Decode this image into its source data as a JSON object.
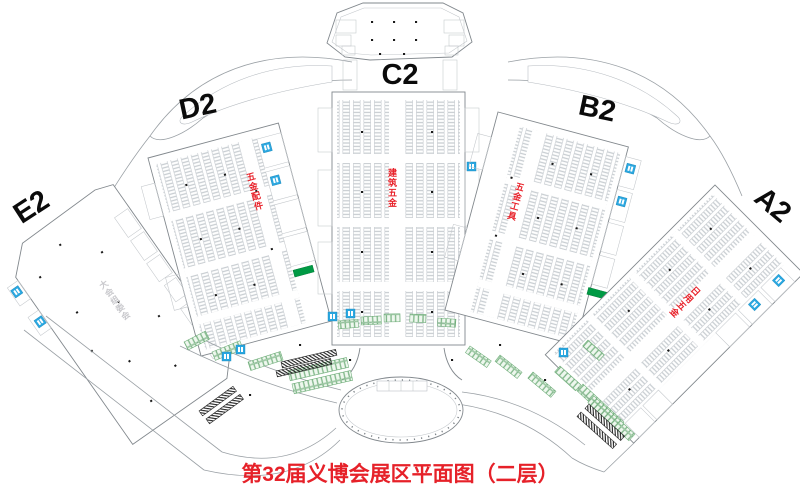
{
  "caption": {
    "text": "第32届义博会展区平面图（二层）",
    "color": "#e62129"
  },
  "halls": [
    {
      "id": "E2",
      "label": "E2",
      "category": "大会组委会",
      "category_color": "#c9c9cd"
    },
    {
      "id": "D2",
      "label": "D2",
      "category": "五金配件",
      "category_color": "#e8232b"
    },
    {
      "id": "C2",
      "label": "C2",
      "category": "建筑五金",
      "category_color": "#e8232b"
    },
    {
      "id": "B2",
      "label": "B2",
      "category": "五金工具",
      "category_color": "#e8232b"
    },
    {
      "id": "A2",
      "label": "A2",
      "category": "日用五金",
      "category_color": "#e8232b"
    }
  ],
  "icons": {
    "toilet": "restroom-square",
    "escalator": "green-escalator-block",
    "stairs": "hatched-stair-strip",
    "booths": "booth-grid-cells"
  },
  "colors": {
    "wall": "#82888d",
    "light_line": "#c3c7cb",
    "booth_line": "#b9bfc5",
    "category_red": "#e8232b",
    "caption_red": "#e62129",
    "toilet_blue": "#2aa7e0",
    "escalator_green": "#009a44",
    "corridor_booth_green": "#69aa74",
    "label_black": "#0b0b0b"
  }
}
